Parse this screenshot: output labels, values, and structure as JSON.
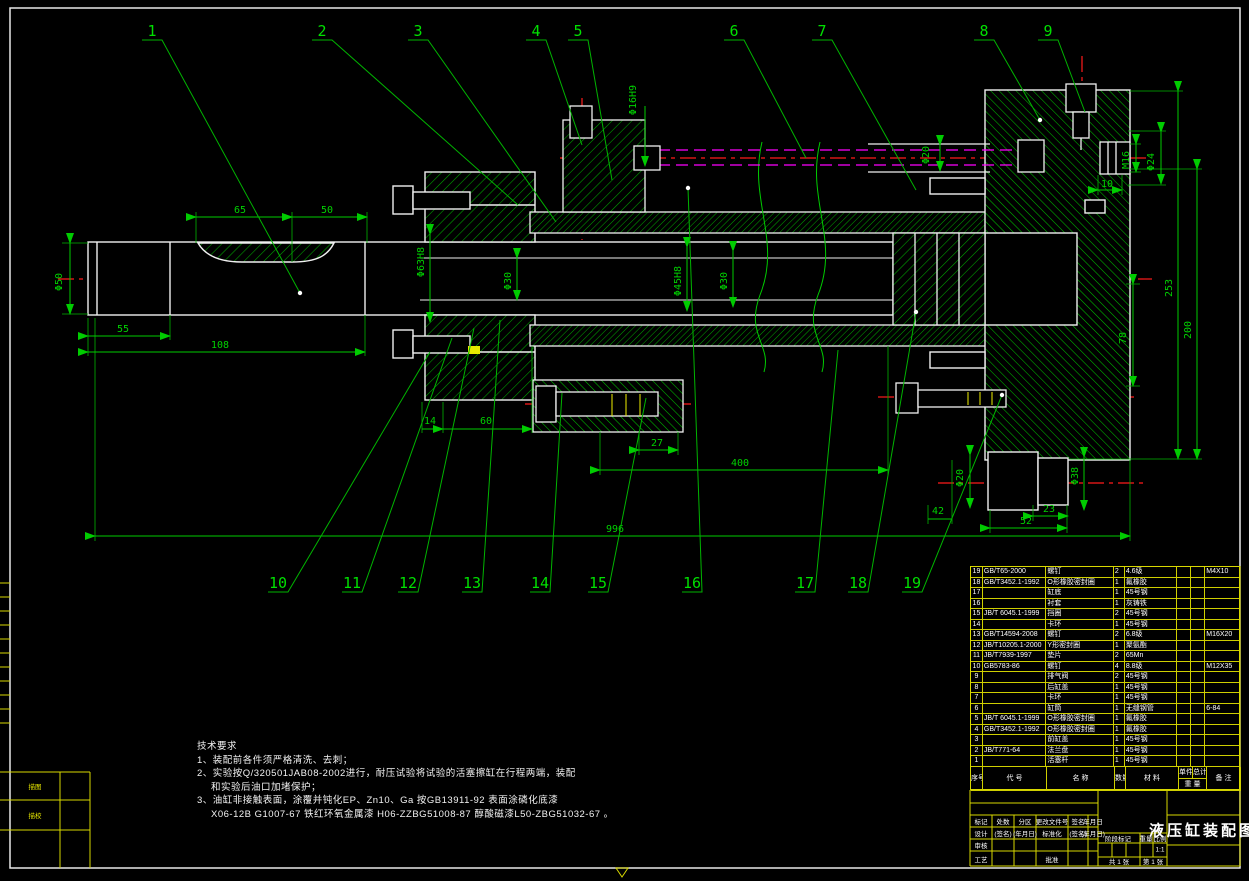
{
  "sheet": {
    "title": "液压缸装配图",
    "scale": "1:1",
    "sheets_total": "共 1 张",
    "sheet_no": "第 1 张"
  },
  "colors": {
    "outline_white": "#f0f0f0",
    "dimension_green": "#00d200",
    "hatch_green": "#00a800",
    "centerline_red": "#ff1a1a",
    "hidden_magenta": "#ff00ff",
    "frame_yellow": "#d8d800"
  },
  "notes": {
    "lines": [
      "技术要求",
      "1、装配前各件须严格清洗、去刺；",
      "2、实验按Q/320501JAB08-2002进行，耐压试验将试验的活塞擦缸在行程两端，装配",
      "和实验后油口加堵保护；",
      "3、油缸非接触表面，涂覆并钝化EP、Zn10、Ga 按GB13911-92 表面涂磷化底漆",
      "X06-12B G1007-67 铁红环氧金属漆 H06-ZZBG51008-87 醇酸磁漆L50-ZBG51032-67 。"
    ]
  },
  "drawing": {
    "dimensions": [
      {
        "text": "Φ50",
        "x": 62,
        "y": 282,
        "rot": true
      },
      {
        "text": "55",
        "x": 123,
        "y": 332
      },
      {
        "text": "108",
        "x": 220,
        "y": 348
      },
      {
        "text": "65",
        "x": 240,
        "y": 213
      },
      {
        "text": "50",
        "x": 327,
        "y": 213
      },
      {
        "text": "Φ63H8",
        "x": 424,
        "y": 262,
        "rot": true
      },
      {
        "text": "Φ30",
        "x": 511,
        "y": 281,
        "rot": true
      },
      {
        "text": "Φ16H9",
        "x": 636,
        "y": 100,
        "rot": true
      },
      {
        "text": "Φ45H8",
        "x": 681,
        "y": 281,
        "rot": true
      },
      {
        "text": "Φ30",
        "x": 727,
        "y": 281,
        "rot": true
      },
      {
        "text": "14",
        "x": 430,
        "y": 424
      },
      {
        "text": "60",
        "x": 486,
        "y": 424
      },
      {
        "text": "27",
        "x": 657,
        "y": 446
      },
      {
        "text": "400",
        "x": 740,
        "y": 466
      },
      {
        "text": "996",
        "x": 615,
        "y": 532
      },
      {
        "text": "42",
        "x": 938,
        "y": 514
      },
      {
        "text": "52",
        "x": 1026,
        "y": 524
      },
      {
        "text": "23",
        "x": 1049,
        "y": 512
      },
      {
        "text": "Φ20",
        "x": 963,
        "y": 478,
        "rot": true
      },
      {
        "text": "Φ38",
        "x": 1078,
        "y": 476,
        "rot": true
      },
      {
        "text": "78",
        "x": 1126,
        "y": 338,
        "rot": true
      },
      {
        "text": "253",
        "x": 1172,
        "y": 288,
        "rot": true
      },
      {
        "text": "200",
        "x": 1191,
        "y": 330,
        "rot": true
      },
      {
        "text": "M16",
        "x": 1129,
        "y": 160,
        "rot": true
      },
      {
        "text": "Φ24",
        "x": 1154,
        "y": 162,
        "rot": true
      },
      {
        "text": "10",
        "x": 1107,
        "y": 187
      },
      {
        "text": "Φ20",
        "x": 929,
        "y": 155,
        "rot": true
      }
    ],
    "callouts": [
      {
        "n": "1",
        "x": 152,
        "y": 36,
        "u": 40,
        "tx": 300,
        "ty": 293,
        "dot": true
      },
      {
        "n": "2",
        "x": 322,
        "y": 36,
        "u": 40,
        "tx": 518,
        "ty": 205
      },
      {
        "n": "3",
        "x": 418,
        "y": 36,
        "u": 40,
        "tx": 556,
        "ty": 222
      },
      {
        "n": "4",
        "x": 536,
        "y": 36,
        "u": 40,
        "tx": 582,
        "ty": 145
      },
      {
        "n": "5",
        "x": 578,
        "y": 36,
        "u": 40,
        "tx": 612,
        "ty": 180
      },
      {
        "n": "6",
        "x": 734,
        "y": 36,
        "u": 40,
        "tx": 806,
        "ty": 158
      },
      {
        "n": "7",
        "x": 822,
        "y": 36,
        "u": 40,
        "tx": 916,
        "ty": 190
      },
      {
        "n": "8",
        "x": 984,
        "y": 36,
        "u": 40,
        "tx": 1040,
        "ty": 120,
        "dot": true
      },
      {
        "n": "9",
        "x": 1048,
        "y": 36,
        "u": 40,
        "tx": 1085,
        "ty": 112
      },
      {
        "n": "10",
        "x": 278,
        "y": 588,
        "u": 592,
        "tx": 430,
        "ty": 352
      },
      {
        "n": "11",
        "x": 352,
        "y": 588,
        "u": 592,
        "tx": 452,
        "ty": 338
      },
      {
        "n": "12",
        "x": 408,
        "y": 588,
        "u": 592,
        "tx": 474,
        "ty": 328
      },
      {
        "n": "13",
        "x": 472,
        "y": 588,
        "u": 592,
        "tx": 500,
        "ty": 320
      },
      {
        "n": "14",
        "x": 540,
        "y": 588,
        "u": 592,
        "tx": 562,
        "ty": 393
      },
      {
        "n": "15",
        "x": 598,
        "y": 588,
        "u": 592,
        "tx": 646,
        "ty": 398
      },
      {
        "n": "16",
        "x": 692,
        "y": 588,
        "u": 592,
        "tx": 688,
        "ty": 188,
        "dot": true
      },
      {
        "n": "17",
        "x": 805,
        "y": 588,
        "u": 592,
        "tx": 838,
        "ty": 350
      },
      {
        "n": "18",
        "x": 858,
        "y": 588,
        "u": 592,
        "tx": 916,
        "ty": 312,
        "dot": true
      },
      {
        "n": "19",
        "x": 912,
        "y": 588,
        "u": 592,
        "tx": 1002,
        "ty": 395,
        "dot": true
      }
    ]
  },
  "parts_table": {
    "headers": {
      "no": "序号",
      "code": "代  号",
      "name": "名  称",
      "qty": "数量",
      "material": "材  料",
      "unit": "单件",
      "total": "总计",
      "weight": "重 量",
      "remark": "备 注"
    },
    "rows": [
      [
        "19",
        "GB/T65-2000",
        "螺钉",
        "2",
        "4.6级",
        "",
        "",
        "M4X10"
      ],
      [
        "18",
        "GB/T3452.1-1992",
        "O形橡胶密封圈",
        "1",
        "氟橡胶",
        "",
        "",
        ""
      ],
      [
        "17",
        "",
        "缸底",
        "1",
        "45号钢",
        "",
        "",
        ""
      ],
      [
        "16",
        "",
        "衬套",
        "1",
        "灰铸铁",
        "",
        "",
        ""
      ],
      [
        "15",
        "JB/T 6045.1-1999",
        "挡圈",
        "2",
        "45号钢",
        "",
        "",
        ""
      ],
      [
        "14",
        "",
        "卡环",
        "1",
        "45号钢",
        "",
        "",
        ""
      ],
      [
        "13",
        "GB/T14594-2008",
        "螺钉",
        "2",
        "6.8级",
        "",
        "",
        "M16X20"
      ],
      [
        "12",
        "JB/T10205.1-2000",
        "Y形密封圈",
        "1",
        "聚氨酯",
        "",
        "",
        ""
      ],
      [
        "11",
        "JB/T7939-1997",
        "垫片",
        "2",
        "65Mn",
        "",
        "",
        ""
      ],
      [
        "10",
        "GB5783-86",
        "螺钉",
        "4",
        "8.8级",
        "",
        "",
        "M12X35"
      ],
      [
        "9",
        "",
        "排气阀",
        "2",
        "45号钢",
        "",
        "",
        ""
      ],
      [
        "8",
        "",
        "后缸盖",
        "1",
        "45号钢",
        "",
        "",
        ""
      ],
      [
        "7",
        "",
        "卡环",
        "1",
        "45号钢",
        "",
        "",
        ""
      ],
      [
        "6",
        "",
        "缸筒",
        "1",
        "无缝钢管",
        "",
        "",
        "6-84"
      ],
      [
        "5",
        "JB/T 6045.1-1999",
        "O形橡胶密封圈",
        "1",
        "氟橡胶",
        "",
        "",
        ""
      ],
      [
        "4",
        "GB/T3452.1-1992",
        "O形橡胶密封圈",
        "1",
        "氟橡胶",
        "",
        "",
        ""
      ],
      [
        "3",
        "",
        "前缸盖",
        "1",
        "45号钢",
        "",
        "",
        ""
      ],
      [
        "2",
        "JB/T771-64",
        "法兰盘",
        "1",
        "45号钢",
        "",
        "",
        ""
      ],
      [
        "1",
        "",
        "活塞杆",
        "1",
        "45号钢",
        "",
        "",
        ""
      ]
    ]
  },
  "title_block": {
    "row1": [
      "标记",
      "处数",
      "分区",
      "更改文件号",
      "签名",
      "年月日"
    ],
    "row2": [
      "设计",
      "(签名)",
      "(年月日)",
      "标准化",
      "(签名)",
      "(年月日)"
    ],
    "shenhe": "审核",
    "gongyi": "工艺",
    "pizhun": "批准",
    "stage": "阶段标记",
    "weight": "重量",
    "scale_label": "比例",
    "miaotu": "描图",
    "miaojiao": "描校"
  }
}
